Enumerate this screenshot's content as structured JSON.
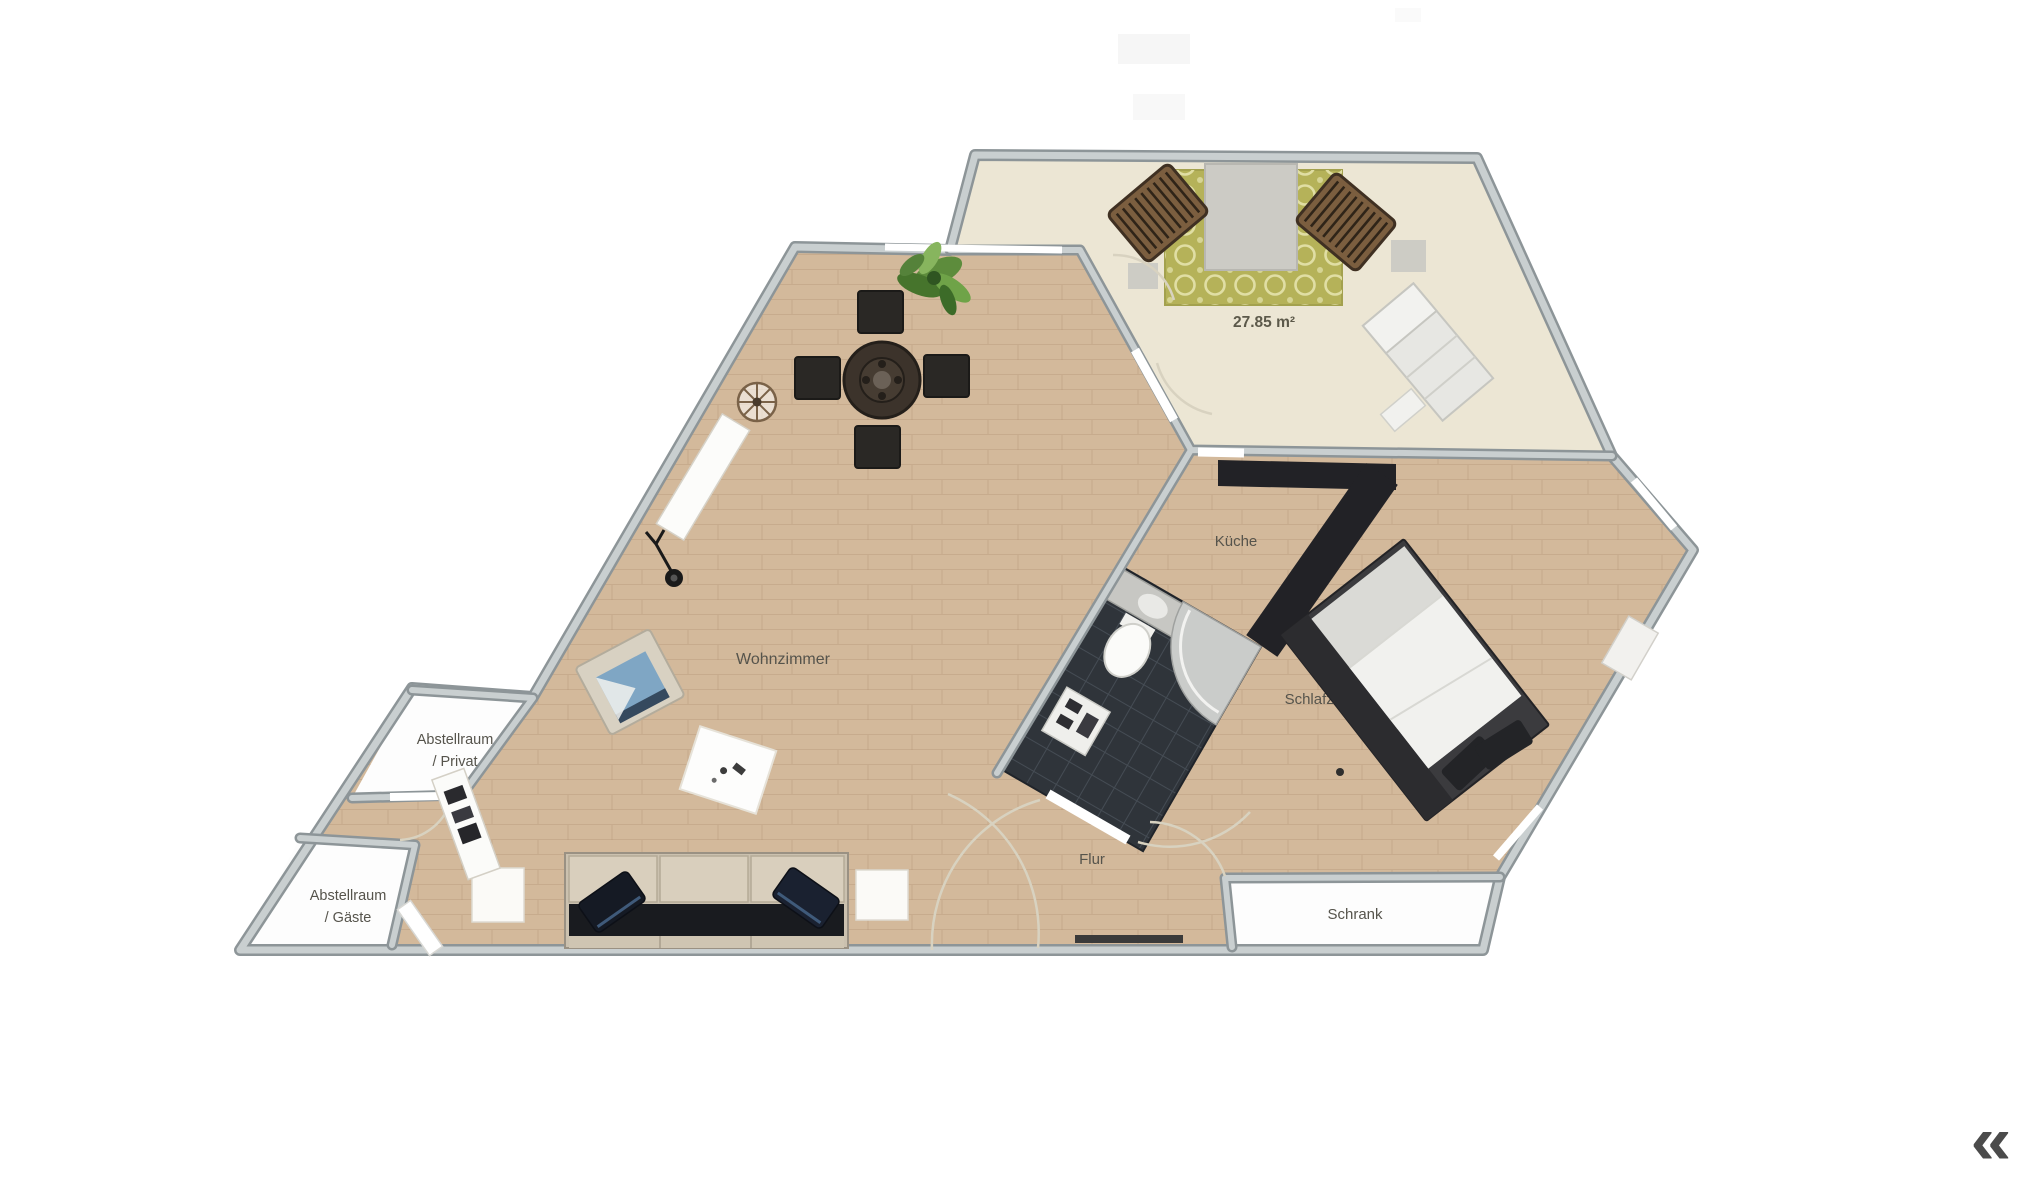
{
  "app": {
    "collapse_chevrons": "«"
  },
  "floorplan": {
    "area_label": "27.85 m²",
    "rooms": {
      "living": "Wohnzimmer",
      "kitchen": "Küche",
      "bedroom": "Schlafzimmer",
      "hallway": "Flur",
      "closet": "Schrank",
      "storage_private_1": "Abstellraum",
      "storage_private_2": "/ Privat",
      "storage_guest_1": "Abstellraum",
      "storage_guest_2": "/ Gäste"
    },
    "colors": {
      "wood_floor": "#d3b99b",
      "terrace_floor": "#ece6d4",
      "bathroom_floor": "#2f343a",
      "wall_fill": "#c9cfd0",
      "wall_edge": "#8d9598",
      "rug_green": "#b5b259",
      "label_text": "#56544c"
    }
  }
}
